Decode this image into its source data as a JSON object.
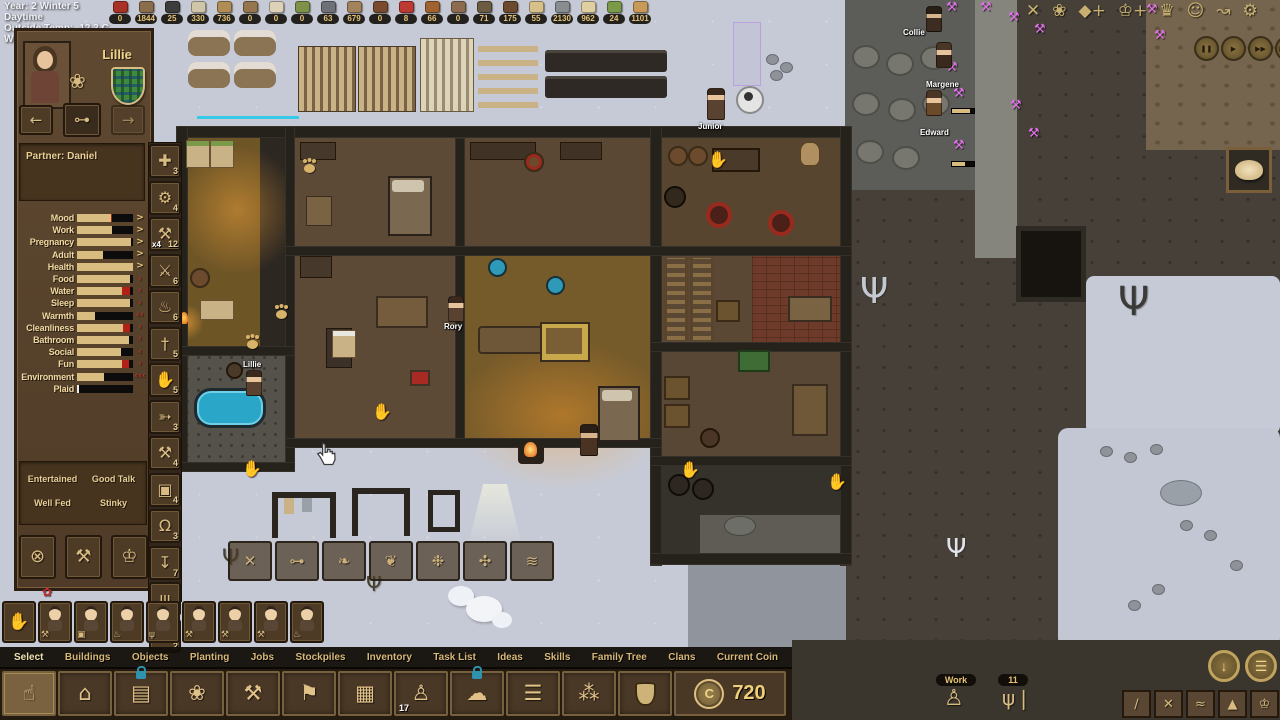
{
  "hud": {
    "clock": [
      "Year: 2 Winter 5 Daytime",
      "Outside Temp: -12.3 C",
      "Wind Chill: -15.7 C"
    ],
    "resources": [
      {
        "icon": "berries-icon",
        "color": "#a83226",
        "count": "0"
      },
      {
        "icon": "twigs-icon",
        "color": "#8a6d4a",
        "count": "1844"
      },
      {
        "icon": "coal-icon",
        "color": "#3c3c3c",
        "count": "25"
      },
      {
        "icon": "stone-icon",
        "color": "#cfc5a8",
        "count": "330"
      },
      {
        "icon": "acorns-icon",
        "color": "#b08d55",
        "count": "736"
      },
      {
        "icon": "hide-icon",
        "color": "#96764e",
        "count": "0"
      },
      {
        "icon": "horn-icon",
        "color": "#ddd2b8",
        "count": "0"
      },
      {
        "icon": "sapling-icon",
        "color": "#7d9148",
        "count": "0"
      },
      {
        "icon": "iron-ingot-icon",
        "color": "#6e7276",
        "count": "63"
      },
      {
        "icon": "log-icon",
        "color": "#a3835c",
        "count": "679"
      },
      {
        "icon": "skewer-icon",
        "color": "#7a4a2e",
        "count": "0"
      },
      {
        "icon": "meat-icon",
        "color": "#bc3a32",
        "count": "8"
      },
      {
        "icon": "squirrel-icon",
        "color": "#a0622e",
        "count": "66"
      },
      {
        "icon": "mushroom-icon",
        "color": "#8d6b4f",
        "count": "0"
      },
      {
        "icon": "branches-icon",
        "color": "#6b5b42",
        "count": "71"
      },
      {
        "icon": "dirt-icon",
        "color": "#6b4a2e",
        "count": "175"
      },
      {
        "icon": "plank-icon",
        "color": "#d8c08a",
        "count": "55"
      },
      {
        "icon": "rocks-icon",
        "color": "#8a8d90",
        "count": "2130"
      },
      {
        "icon": "cloth-icon",
        "color": "#e0cfa0",
        "count": "962"
      },
      {
        "icon": "bowl-icon",
        "color": "#7a9a4a",
        "count": "24"
      },
      {
        "icon": "pouch-icon",
        "color": "#c89a5a",
        "count": "1101"
      }
    ],
    "top_right_icons": [
      {
        "icon": "cancel-icon",
        "glyph": "✕"
      },
      {
        "icon": "plant-pot-icon",
        "glyph": "❀"
      },
      {
        "icon": "water-plus-icon",
        "glyph": "◆+"
      },
      {
        "icon": "crown-plus-icon",
        "glyph": "♔+"
      },
      {
        "icon": "crown-icon",
        "glyph": "♛"
      },
      {
        "icon": "happiness-icon",
        "glyph": "☺"
      },
      {
        "icon": "route-icon",
        "glyph": "↝"
      },
      {
        "icon": "settings-gear-icon",
        "glyph": "⚙"
      }
    ],
    "time_controls": [
      {
        "icon": "pause-icon",
        "glyph": "❚❚"
      },
      {
        "icon": "play-icon",
        "glyph": "▶"
      },
      {
        "icon": "fast-icon",
        "glyph": "▶▶"
      },
      {
        "icon": "fastest-icon",
        "glyph": "▶▶▶"
      }
    ],
    "circle_buttons": [
      {
        "icon": "coin-down-icon",
        "glyph": "↓"
      },
      {
        "icon": "coin-ledger-icon",
        "glyph": "☰"
      }
    ]
  },
  "character_panel": {
    "name": "Lillie",
    "partner": "Partner: Daniel",
    "nav": {
      "prev": "←",
      "next": "→",
      "key_glyph": "⊶",
      "job_glyph": "❀"
    },
    "needs": [
      {
        "label": "Mood",
        "fill": 60,
        "red": 3,
        "fill_color": "#d9bc80",
        "suffix": ">",
        "suffix_color": "#e8c87a"
      },
      {
        "label": "Work",
        "fill": 63,
        "red": 0,
        "fill_color": "#d9bc80",
        "suffix": ">",
        "suffix_color": "#e8c87a"
      },
      {
        "label": "Pregnancy",
        "fill": 96,
        "red": 0,
        "fill_color": "#d9bc80",
        "suffix": ">",
        "suffix_color": "#e8c87a"
      },
      {
        "label": "Adult",
        "fill": 47,
        "red": 0,
        "fill_color": "#d9bc80",
        "suffix": ">",
        "suffix_color": "#e8c87a"
      },
      {
        "label": "Health",
        "fill": 100,
        "red": 0,
        "fill_color": "#d9bc80",
        "suffix": ">",
        "suffix_color": "#e8c87a"
      },
      {
        "label": "Food",
        "fill": 94,
        "red": 0,
        "fill_color": "#d9bc80",
        "suffix": "‹",
        "suffix_color": "#c2302a"
      },
      {
        "label": "Water",
        "fill": 80,
        "red": 14,
        "fill_color": "#d9bc80",
        "suffix": "‹",
        "suffix_color": "#c2302a"
      },
      {
        "label": "Sleep",
        "fill": 94,
        "red": 0,
        "fill_color": "#d9bc80",
        "suffix": "‹",
        "suffix_color": "#c2302a"
      },
      {
        "label": "Warmth",
        "fill": 33,
        "red": 0,
        "fill_color": "#d9bc80",
        "suffix": "‹‹",
        "suffix_color": "#c2302a"
      },
      {
        "label": "Cleanliness",
        "fill": 82,
        "red": 12,
        "fill_color": "#d9bc80",
        "suffix": "‹",
        "suffix_color": "#c2302a"
      },
      {
        "label": "Bathroom",
        "fill": 92,
        "red": 0,
        "fill_color": "#d9bc80",
        "suffix": "‹",
        "suffix_color": "#c2302a"
      },
      {
        "label": "Social",
        "fill": 78,
        "red": 0,
        "fill_color": "#d9bc80",
        "suffix": "‹",
        "suffix_color": "#c2302a"
      },
      {
        "label": "Fun",
        "fill": 80,
        "red": 12,
        "fill_color": "#d9bc80",
        "suffix": "‹",
        "suffix_color": "#c2302a"
      },
      {
        "label": "Environment",
        "fill": 48,
        "red": 0,
        "fill_color": "#d9bc80",
        "suffix": "‹‹‹",
        "suffix_color": "#c2302a"
      },
      {
        "label": "Plaid",
        "fill": 4,
        "red": 0,
        "fill_color": "#ececec",
        "suffix": "",
        "suffix_color": ""
      }
    ],
    "statuses": [
      "Entertained",
      "Good Talk",
      "Well Fed",
      "Stinky"
    ],
    "action_buttons": [
      {
        "icon": "forbid-icon",
        "glyph": "⊗"
      },
      {
        "icon": "dig-icon",
        "glyph": "⚒"
      },
      {
        "icon": "celebration-icon",
        "glyph": "♔"
      }
    ]
  },
  "left_toolbar": [
    {
      "icon": "medkit-icon",
      "glyph": "✚",
      "count": "3"
    },
    {
      "icon": "wrench-icon",
      "glyph": "⚙",
      "count": "4"
    },
    {
      "icon": "pickaxe-icon",
      "glyph": "⚒",
      "xbadge": "x4",
      "count": "12"
    },
    {
      "icon": "scythe-icon",
      "glyph": "⚔",
      "count": "6"
    },
    {
      "icon": "watering-pot-icon",
      "glyph": "♨",
      "count": "6"
    },
    {
      "icon": "axe-icon",
      "glyph": "†",
      "count": "5"
    },
    {
      "icon": "gather-hand-icon",
      "glyph": "✋",
      "count": "5"
    },
    {
      "icon": "hunt-bow-icon",
      "glyph": "➳",
      "count": "3"
    },
    {
      "icon": "build-hammer-icon",
      "glyph": "⚒",
      "count": "4"
    },
    {
      "icon": "basket-icon",
      "glyph": "▣",
      "count": "4"
    },
    {
      "icon": "anvil-icon",
      "glyph": "Ω",
      "count": "3"
    },
    {
      "icon": "haul-crate-icon",
      "glyph": "↧",
      "count": "7"
    },
    {
      "icon": "broom-icon",
      "glyph": "ψ",
      "count": "3"
    },
    {
      "icon": "shirt-icon",
      "glyph": "T",
      "count": "2"
    }
  ],
  "overlay_buttons": [
    {
      "icon": "route-x-icon",
      "glyph": "✕"
    },
    {
      "icon": "key-lock-icon",
      "glyph": "⊶"
    },
    {
      "icon": "hare-icon",
      "glyph": "❧"
    },
    {
      "icon": "squirrel-toggle-icon",
      "glyph": "❦"
    },
    {
      "icon": "plant-toggle-icon",
      "glyph": "❉"
    },
    {
      "icon": "vermin-icon",
      "glyph": "✣"
    },
    {
      "icon": "ledger-icon",
      "glyph": "≋"
    }
  ],
  "villager_strip": {
    "hand_glyph": "✋",
    "villagers": [
      {
        "tool_icon": "pickaxe-icon",
        "tool_glyph": "⚒"
      },
      {
        "tool_icon": "crate-icon",
        "tool_glyph": "▣"
      },
      {
        "tool_icon": "bucket-icon",
        "tool_glyph": "♨"
      },
      {
        "tool_icon": "broom-icon",
        "tool_glyph": "ψ"
      },
      {
        "tool_icon": "pickaxe-icon",
        "tool_glyph": "⚒"
      },
      {
        "tool_icon": "hammer-icon",
        "tool_glyph": "⚒"
      },
      {
        "tool_icon": "pickaxe-icon",
        "tool_glyph": "⚒"
      },
      {
        "tool_icon": "bucket-icon",
        "tool_glyph": "♨"
      }
    ]
  },
  "bottom_menu": {
    "tabs": [
      {
        "label": "Select",
        "state": "tab-active"
      },
      {
        "label": "Buildings"
      },
      {
        "label": "Objects"
      },
      {
        "label": "Planting"
      },
      {
        "label": "Jobs"
      },
      {
        "label": "Stockpiles"
      },
      {
        "label": "Inventory"
      },
      {
        "label": "Task List"
      },
      {
        "label": "Ideas"
      },
      {
        "label": "Skills"
      },
      {
        "label": "Family Tree"
      },
      {
        "label": "Clans"
      },
      {
        "label": "Current Coin"
      }
    ]
  },
  "bottom_toolbar": {
    "items": [
      {
        "icon": "select-tool-icon",
        "glyph": "☝",
        "state": "cell-active"
      },
      {
        "icon": "buildings-icon",
        "glyph": "⌂"
      },
      {
        "icon": "objects-bed-icon",
        "glyph": "▤",
        "lock": true
      },
      {
        "icon": "planting-icon",
        "glyph": "❀"
      },
      {
        "icon": "jobs-pickaxe-icon",
        "glyph": "⚒"
      },
      {
        "icon": "stockpile-flag-icon",
        "glyph": "⚑"
      },
      {
        "icon": "inventory-chest-icon",
        "glyph": "▦"
      },
      {
        "icon": "tasklist-miner-icon",
        "glyph": "♙",
        "badge": "17"
      },
      {
        "icon": "ideas-bubble-icon",
        "glyph": "☁",
        "lock": true
      },
      {
        "icon": "skills-list-icon",
        "glyph": "☰"
      },
      {
        "icon": "familytree-icon",
        "glyph": "⁂"
      },
      {
        "icon": "clans-icon",
        "glyph": ""
      }
    ],
    "coin_glyph": "C",
    "coin_value": "720"
  },
  "bottom_right": {
    "work_label": "Work",
    "miner_glyph": "♙",
    "meal_count": "11",
    "fork_glyph": "ψ❘",
    "farm_buttons": [
      {
        "icon": "harvest-icon",
        "glyph": "∕"
      },
      {
        "icon": "cancel-field-icon",
        "glyph": "✕"
      },
      {
        "icon": "fertilize-icon",
        "glyph": "≈"
      },
      {
        "icon": "mound-icon",
        "glyph": "▲"
      },
      {
        "icon": "festival-icon",
        "glyph": "♔"
      }
    ]
  },
  "map": {
    "labels": [
      "Collie",
      "Margene",
      "Edward",
      "Junior",
      "Rory",
      "Lillie"
    ],
    "frame_item": "bread"
  }
}
